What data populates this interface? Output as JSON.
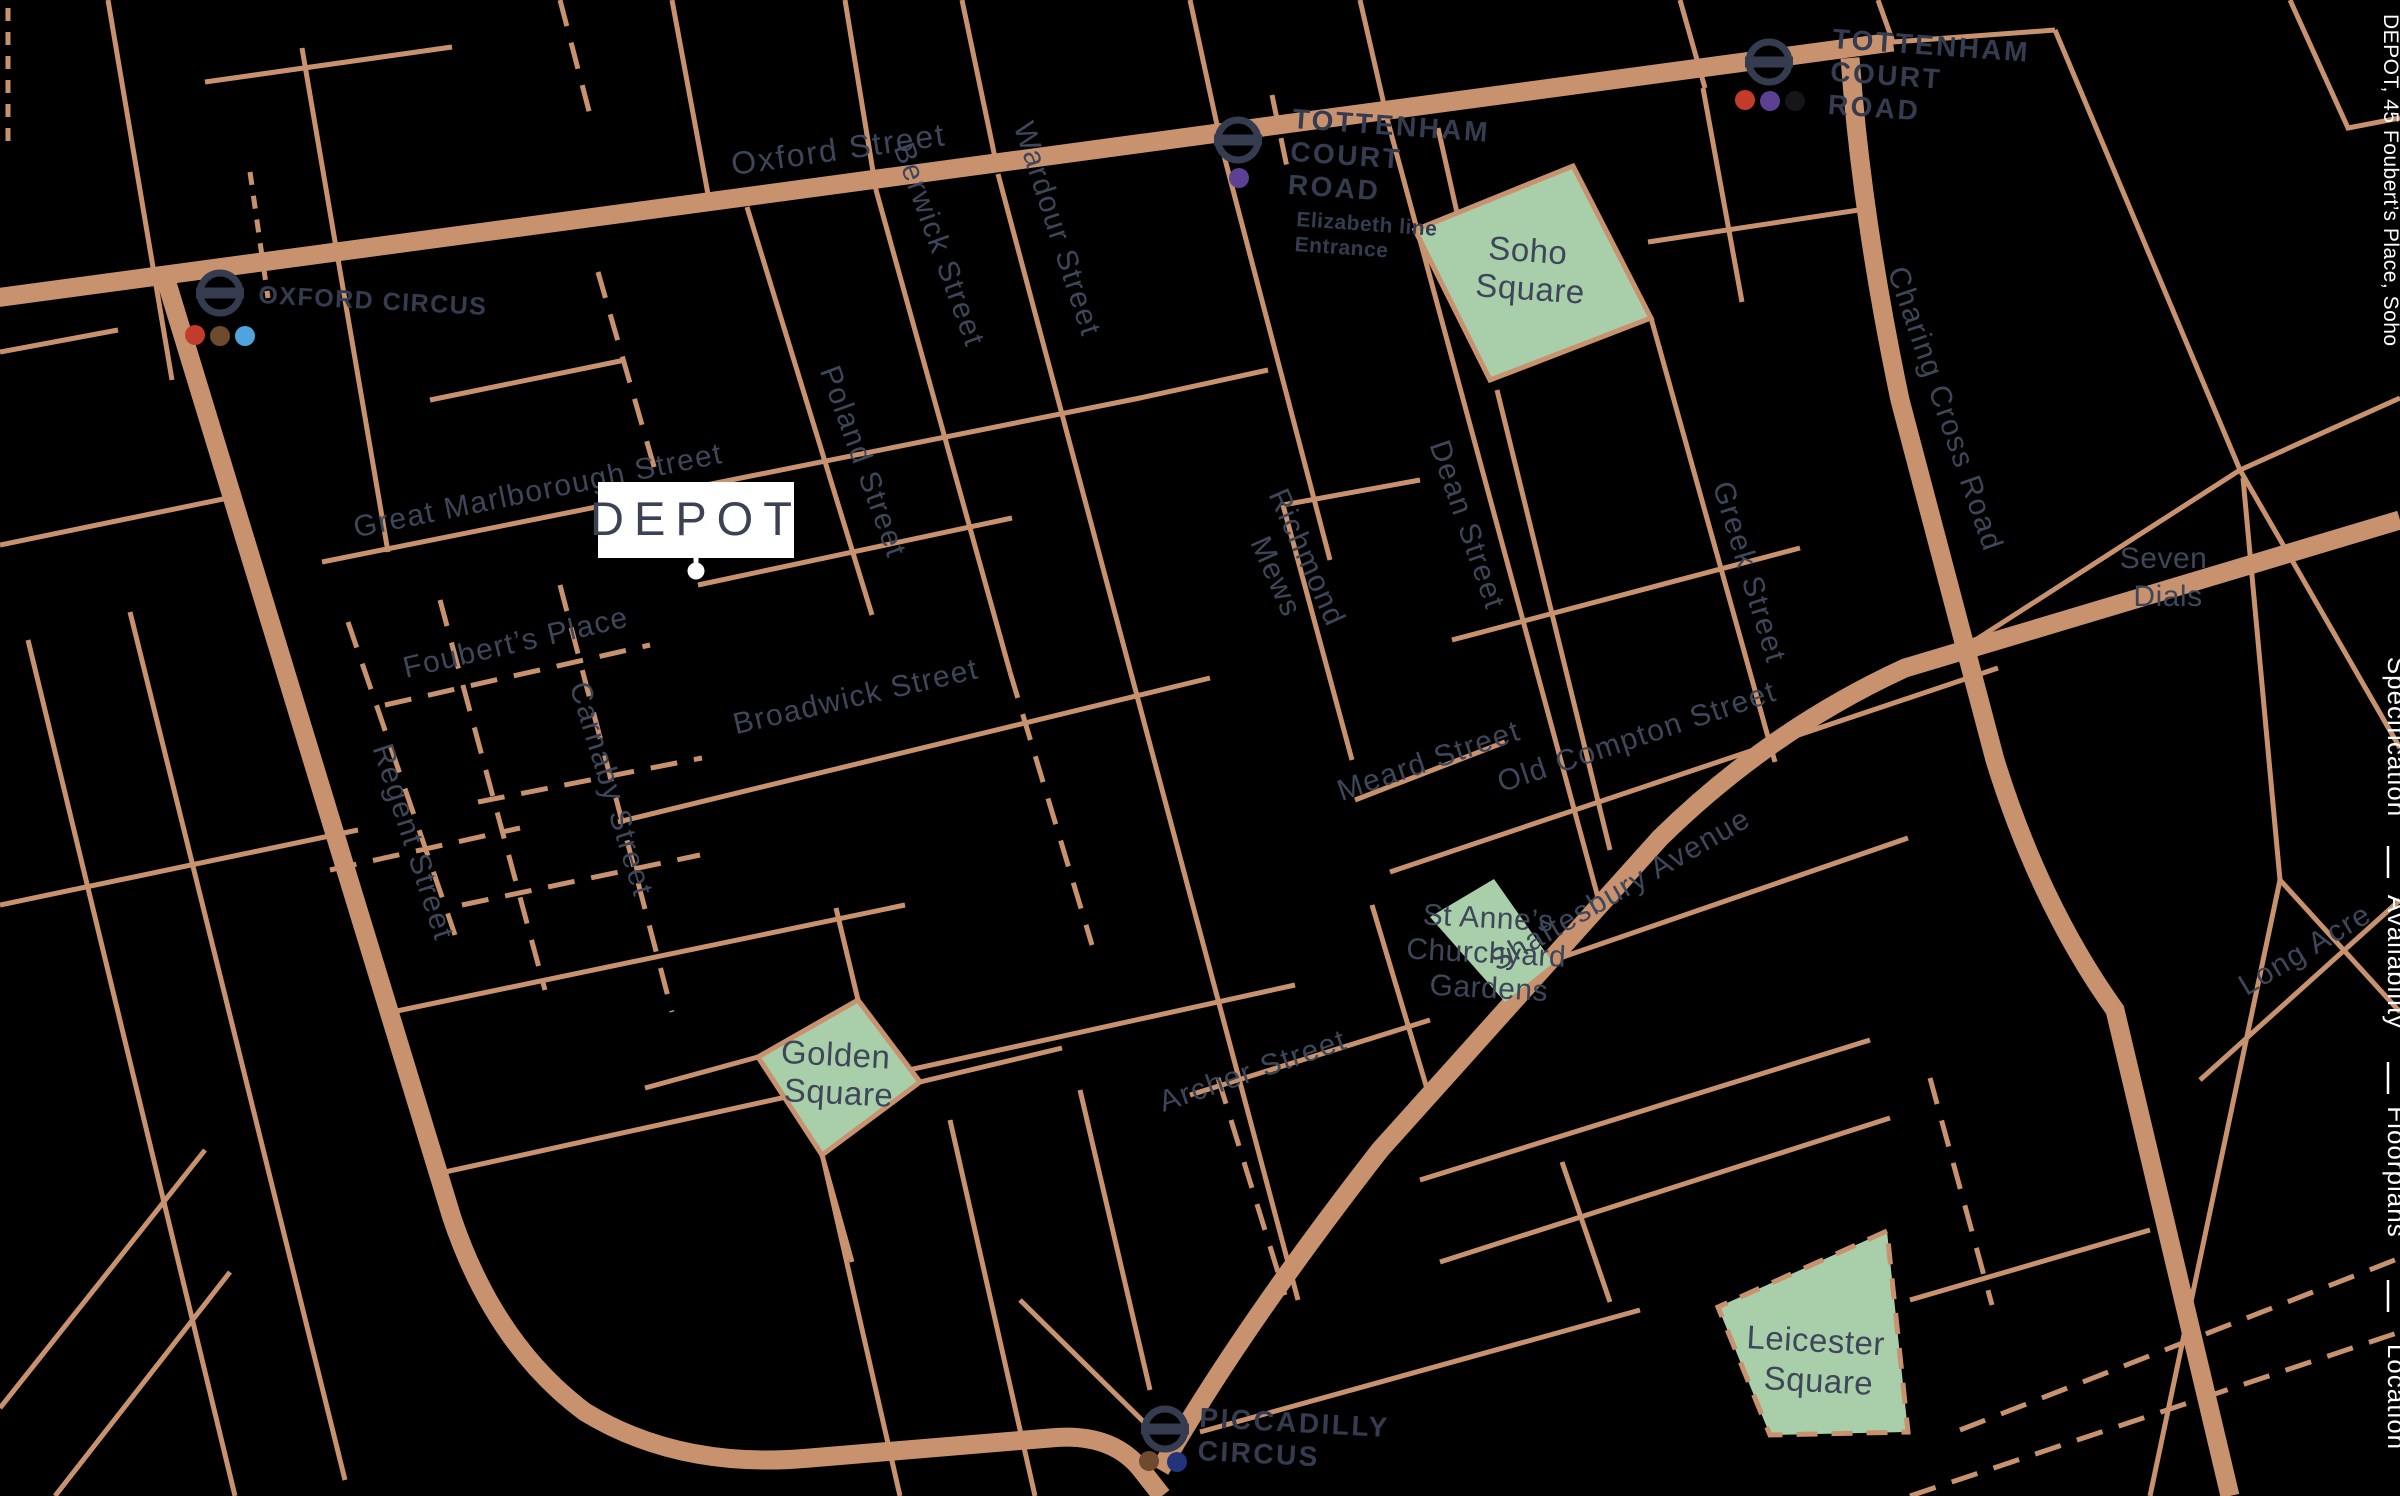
{
  "map": {
    "colors": {
      "background": "#000000",
      "street": "#C9926F",
      "street_label": "#3E4659",
      "station_label": "#353C4F",
      "park_fill": "#A9CEAA",
      "park_border": "#C9926F",
      "marker_bg": "#FFFFFF",
      "marker_text": "#3A4254",
      "nav_text": "#FFFFFF"
    },
    "marker": {
      "label": "DEPOT"
    },
    "street_labels": [
      {
        "text": "Oxford Street"
      },
      {
        "text": "Great Marlborough Street"
      },
      {
        "text": "Foubert’s Place"
      },
      {
        "text": "Carnaby Street"
      },
      {
        "text": "Regent Street"
      },
      {
        "text": "Poland Street"
      },
      {
        "text": "Berwick Street"
      },
      {
        "text": "Wardour Street"
      },
      {
        "text": "Broadwick Street"
      },
      {
        "text": "Dean Street"
      },
      {
        "text": "Richmond Mews",
        "lines": [
          "Richmond",
          "Mews"
        ]
      },
      {
        "text": "Meard Street"
      },
      {
        "text": "Old Compton Street"
      },
      {
        "text": "Greek Street"
      },
      {
        "text": "Charing Cross Road"
      },
      {
        "text": "Shaftesbury Avenue"
      },
      {
        "text": "Archer Street"
      },
      {
        "text": "Long Acre"
      }
    ],
    "stations": [
      {
        "id": "oxford-circus",
        "name_lines": [
          "OXFORD CIRCUS"
        ],
        "line_colors": [
          "#C33B2B",
          "#6F4B2E",
          "#4FA4DC"
        ]
      },
      {
        "id": "tottenham-court-road-elizabeth",
        "name_lines": [
          "TOTTENHAM",
          "COURT",
          "ROAD"
        ],
        "sub_lines": [
          "Elizabeth line",
          "Entrance"
        ],
        "line_colors": [
          "#5C4193"
        ]
      },
      {
        "id": "tottenham-court-road",
        "name_lines": [
          "TOTTENHAM",
          "COURT",
          "ROAD"
        ],
        "line_colors": [
          "#C33B2B",
          "#5C4193",
          "#15151A"
        ]
      },
      {
        "id": "piccadilly-circus",
        "name_lines": [
          "PICCADILLY",
          "CIRCUS"
        ],
        "line_colors": [
          "#6F4B2E",
          "#22347C"
        ]
      }
    ],
    "parks": [
      {
        "name": "Soho Square",
        "lines": [
          "Soho",
          "Square"
        ]
      },
      {
        "name": "Golden Square",
        "lines": [
          "Golden",
          "Square"
        ]
      },
      {
        "name": "St Anne’s Churchyard Gardens",
        "lines": [
          "St Anne’s",
          "Churchyard",
          "Gardens"
        ]
      },
      {
        "name": "Leicester Square",
        "lines": [
          "Leicester",
          "Square"
        ]
      }
    ],
    "areas": [
      {
        "name": "Seven Dials",
        "lines": [
          "Seven",
          "Dials"
        ]
      }
    ]
  },
  "sidebar": {
    "title": "DEPOT, 45 Foubert’s Place, Soho",
    "items": [
      {
        "label": "Specification"
      },
      {
        "label": "Availability"
      },
      {
        "label": "Floorplans"
      },
      {
        "label": "Location"
      }
    ]
  }
}
